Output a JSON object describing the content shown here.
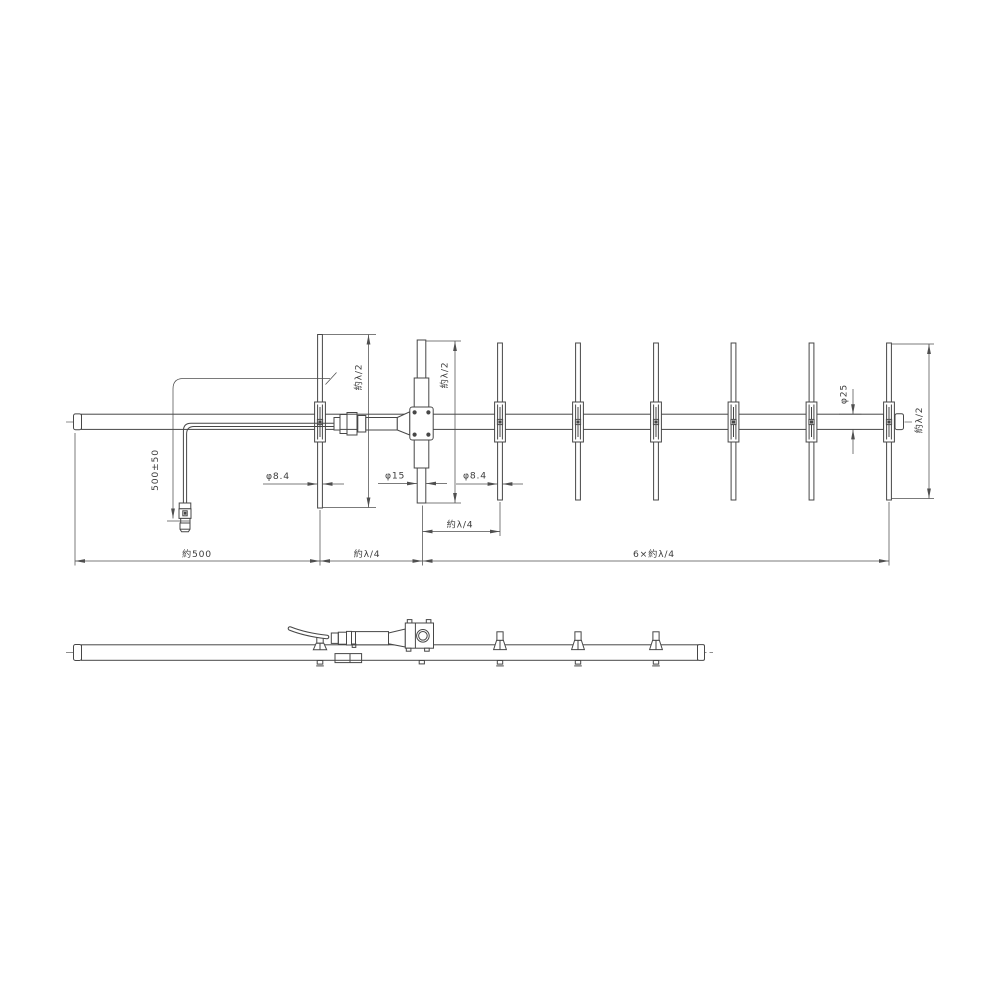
{
  "drawing": {
    "kind": "yagi-antenna-dimensional-drawing",
    "structure": {
      "director_count": 6,
      "views": [
        "plan-view-with-dimensions",
        "side-view"
      ]
    },
    "colors": {
      "background": "#ffffff",
      "line": "#474747",
      "text": "#3c3c3c"
    },
    "dimensions": {
      "reflector_length": "約λ/2",
      "driven_element_length": "約λ/2",
      "last_director_length": "約λ/2",
      "cable_length": "500±50",
      "reflector_diameter": "φ8.4",
      "driven_element_diameter": "φ15",
      "director_diameter": "φ8.4",
      "boom_diameter": "φ25",
      "front_boom_length": "約500",
      "reflector_to_driven_spacing": "約λ/4",
      "driven_to_first_director_spacing": "約λ/4",
      "directors_span": "6×約λ/4"
    }
  }
}
